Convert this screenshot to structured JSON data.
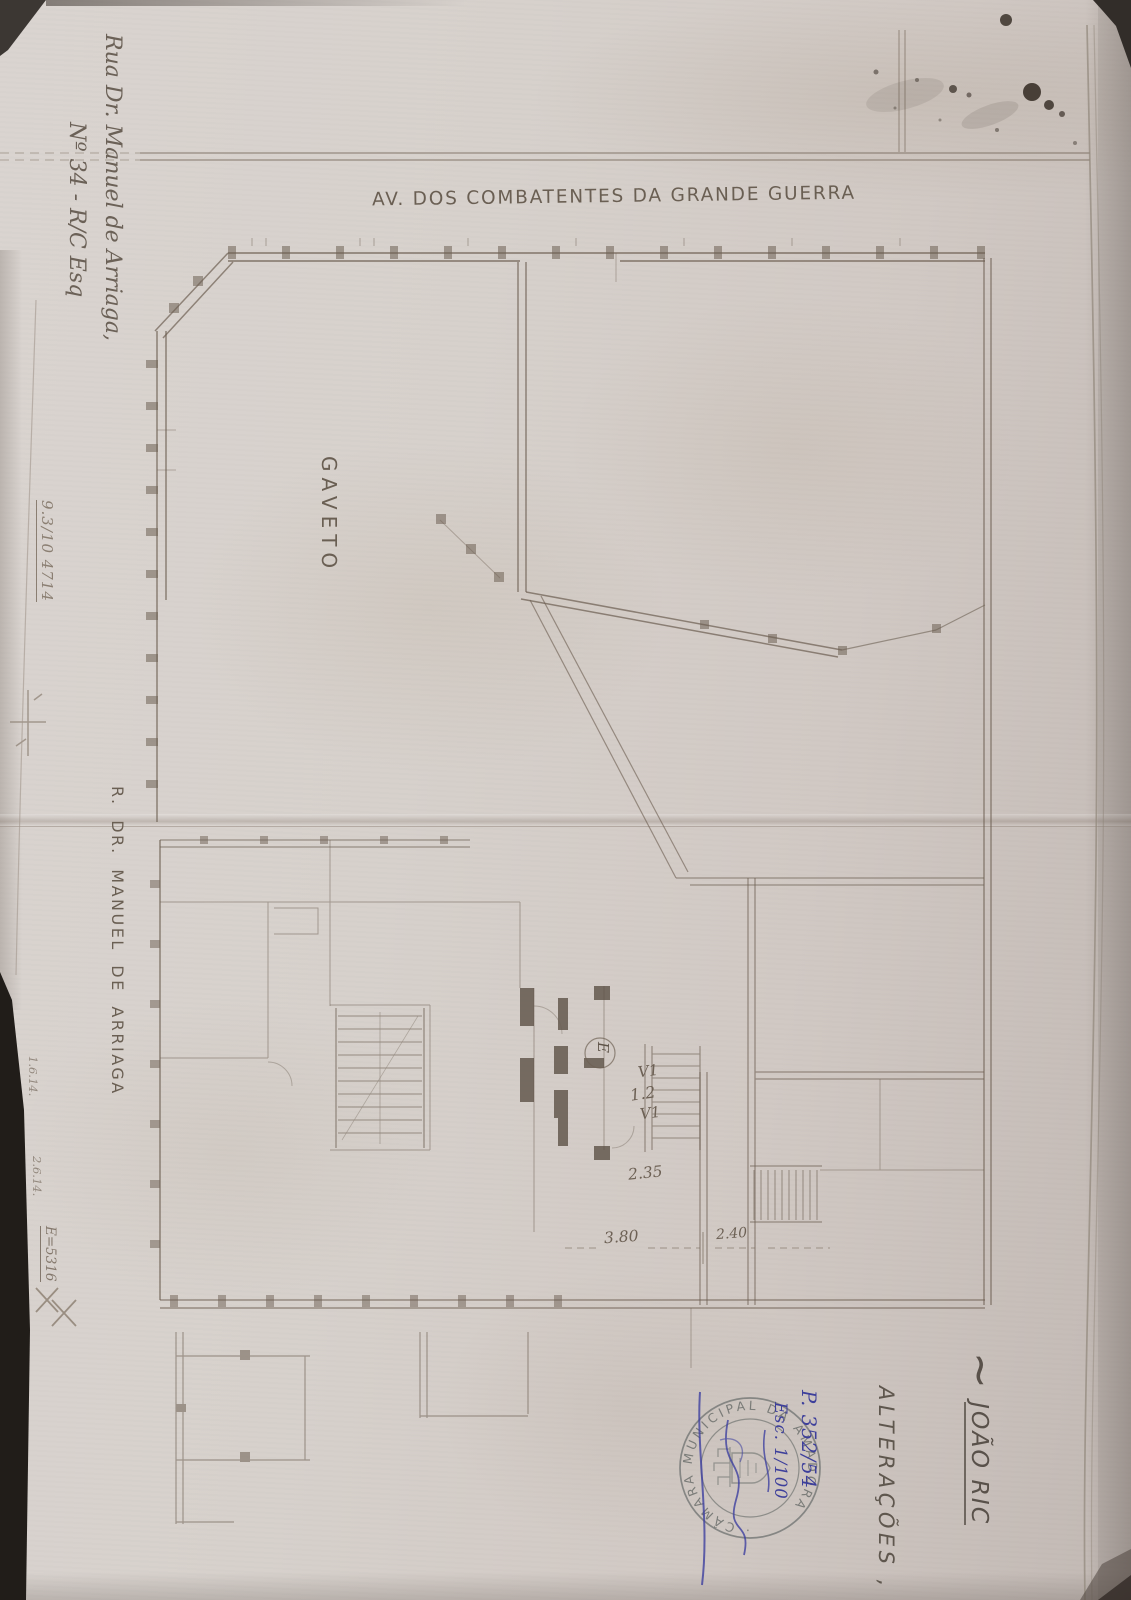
{
  "colors": {
    "paper": "#d6cfca",
    "plan_ink": "#6d6053",
    "pencil": "#8d8175",
    "blue_ink": "#3d3f9b",
    "stamp_ink": "#666a67",
    "edge_dark": "#211d19"
  },
  "labels": {
    "avenue_top": "AV. DOS COMBATENTES DA GRANDE GUERRA",
    "gaveto": "GAVETO",
    "street_left": "R. DR. MANUEL DE ARRIAGA",
    "title_tilde": "~",
    "title_name": "JOÃO RIC",
    "alteracoes": "ALTERAÇÕES ,"
  },
  "margin_notes": {
    "address_line1": "Rua Dr. Manuel de Arriaga,",
    "address_line2": "Nº 34 - R/C Esq",
    "pencil_ref": "9.3/10 4714",
    "pencil_note1": "1.6.14.",
    "pencil_note2": "2.6.14.",
    "pencil_note3": "E=5316"
  },
  "dimensions": {
    "v1_upper": "V1",
    "d12": "1.2",
    "v1_lower": "V1",
    "d235": "2.35",
    "d380": "3.80",
    "d240": "2.40",
    "elevator_letter": "E"
  },
  "stamp": {
    "ring_text": "· CÂMARA MUNICIPAL DA AMADORA",
    "annotation_process": "P. 352/54",
    "annotation_scale": "Esc. 1/100"
  }
}
